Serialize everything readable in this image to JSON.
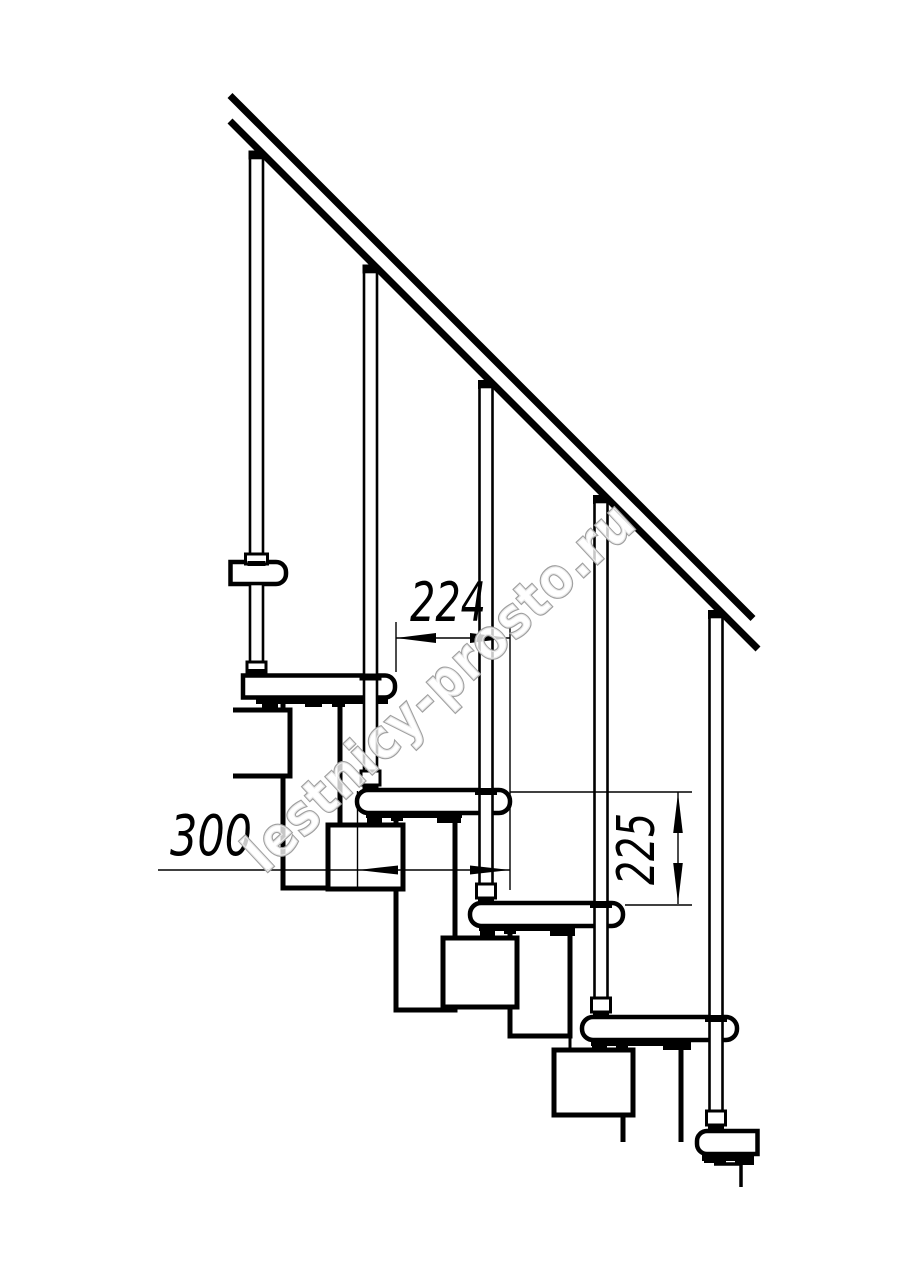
{
  "page": {
    "background": "#ffffff"
  },
  "drawing": {
    "description": "Side-view technical drawing of a modular staircase with handrail, balusters, treads and module chain",
    "line_color": "#000000",
    "dimensions": [
      {
        "id": "step-run",
        "label": "224"
      },
      {
        "id": "tread-depth",
        "label": "300"
      },
      {
        "id": "riser-height",
        "label": "225"
      }
    ],
    "watermark": {
      "text": "lestnicy-prosto.ru",
      "fill": "#ffffff",
      "outline": "#9f9f9f"
    }
  }
}
